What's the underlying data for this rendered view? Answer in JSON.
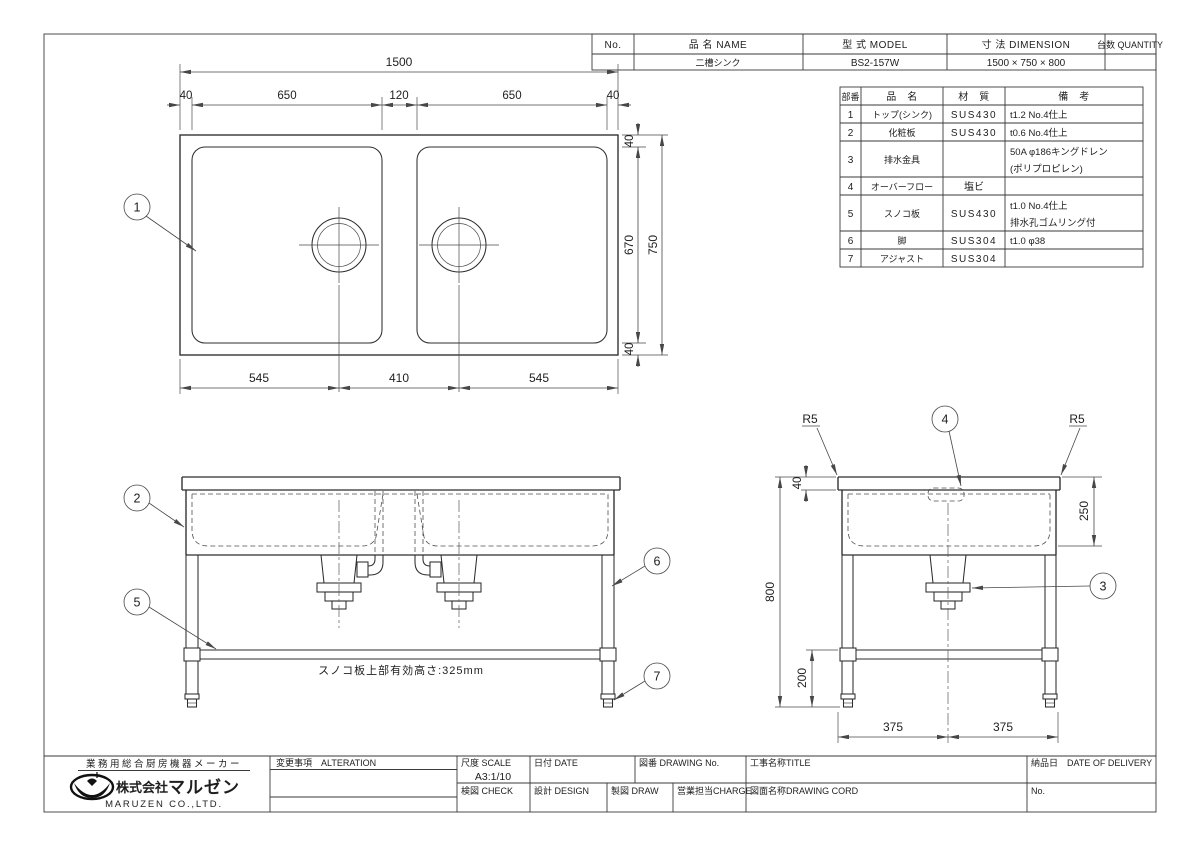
{
  "colors": {
    "ink": "#2d2d2d",
    "paper": "#ffffff"
  },
  "header_table": {
    "cols": {
      "no": "No.",
      "name": "品 名  NAME",
      "model": "型 式  MODEL",
      "dimension": "寸 法  DIMENSION",
      "quantity": "台数 QUANTITY"
    },
    "row": {
      "no": "",
      "name": "二槽シンク",
      "model": "BS2-157W",
      "dimension": "1500 × 750 × 800",
      "quantity": ""
    }
  },
  "parts_table": {
    "headers": {
      "no": "部番",
      "name": "品　名",
      "material": "材　質",
      "remarks": "備　考"
    },
    "rows": [
      {
        "no": "1",
        "name": "トップ(シンク)",
        "material": "SUS430",
        "remarks1": "t1.2 No.4仕上",
        "remarks2": ""
      },
      {
        "no": "2",
        "name": "化粧板",
        "material": "SUS430",
        "remarks1": "t0.6 No.4仕上",
        "remarks2": ""
      },
      {
        "no": "3",
        "name": "排水金具",
        "material": "",
        "remarks1": "50A φ186キングドレン",
        "remarks2": "(ポリプロピレン)"
      },
      {
        "no": "4",
        "name": "オーバーフロー",
        "material": "塩ビ",
        "remarks1": "",
        "remarks2": ""
      },
      {
        "no": "5",
        "name": "スノコ板",
        "material": "SUS430",
        "remarks1": "t1.0 No.4仕上",
        "remarks2": "排水孔ゴムリング付"
      },
      {
        "no": "6",
        "name": "脚",
        "material": "SUS304",
        "remarks1": "t1.0 φ38",
        "remarks2": ""
      },
      {
        "no": "7",
        "name": "アジャスト",
        "material": "SUS304",
        "remarks1": "",
        "remarks2": ""
      }
    ]
  },
  "drawing": {
    "balloons": {
      "b1": "1",
      "b2": "2",
      "b3": "3",
      "b4": "4",
      "b5": "5",
      "b6": "6",
      "b7": "7"
    },
    "plan": {
      "w_total": "1500",
      "w_margin_l": "40",
      "w_sink_l": "650",
      "w_center": "120",
      "w_sink_r": "650",
      "w_margin_r": "40",
      "b_left": "545",
      "b_center": "410",
      "b_right": "545",
      "s_top": "40",
      "s_inner": "670",
      "s_bottom": "40",
      "s_total": "750"
    },
    "front": {
      "note": "スノコ板上部有効高さ:325mm"
    },
    "side": {
      "r_left": "R5",
      "r_right": "R5",
      "top_thk": "40",
      "height": "800",
      "depth": "250",
      "shelf": "200",
      "half_l": "375",
      "half_r": "375"
    }
  },
  "title_block": {
    "maker_tagline": "業務用総合厨房機器メーカー",
    "company_prefix": "株式会社",
    "company_name": "マルゼン",
    "company_en": "MARUZEN CO.,LTD.",
    "alteration_label": "変更事項　ALTERATION",
    "scale_label": "尺度 SCALE",
    "scale_value": "A3:1/10",
    "date_label": "日付 DATE",
    "drawing_no_label": "図番 DRAWING No.",
    "title_label": "工事名称TITLE",
    "delivery_label": "納品日　DATE OF DELIVERY",
    "check_label": "検図 CHECK",
    "design_label": "設計 DESIGN",
    "draw_label": "製図 DRAW",
    "charge_label": "営業担当CHARGE",
    "drawing_cord_label": "図面名称DRAWING CORD",
    "no_label": "No."
  }
}
